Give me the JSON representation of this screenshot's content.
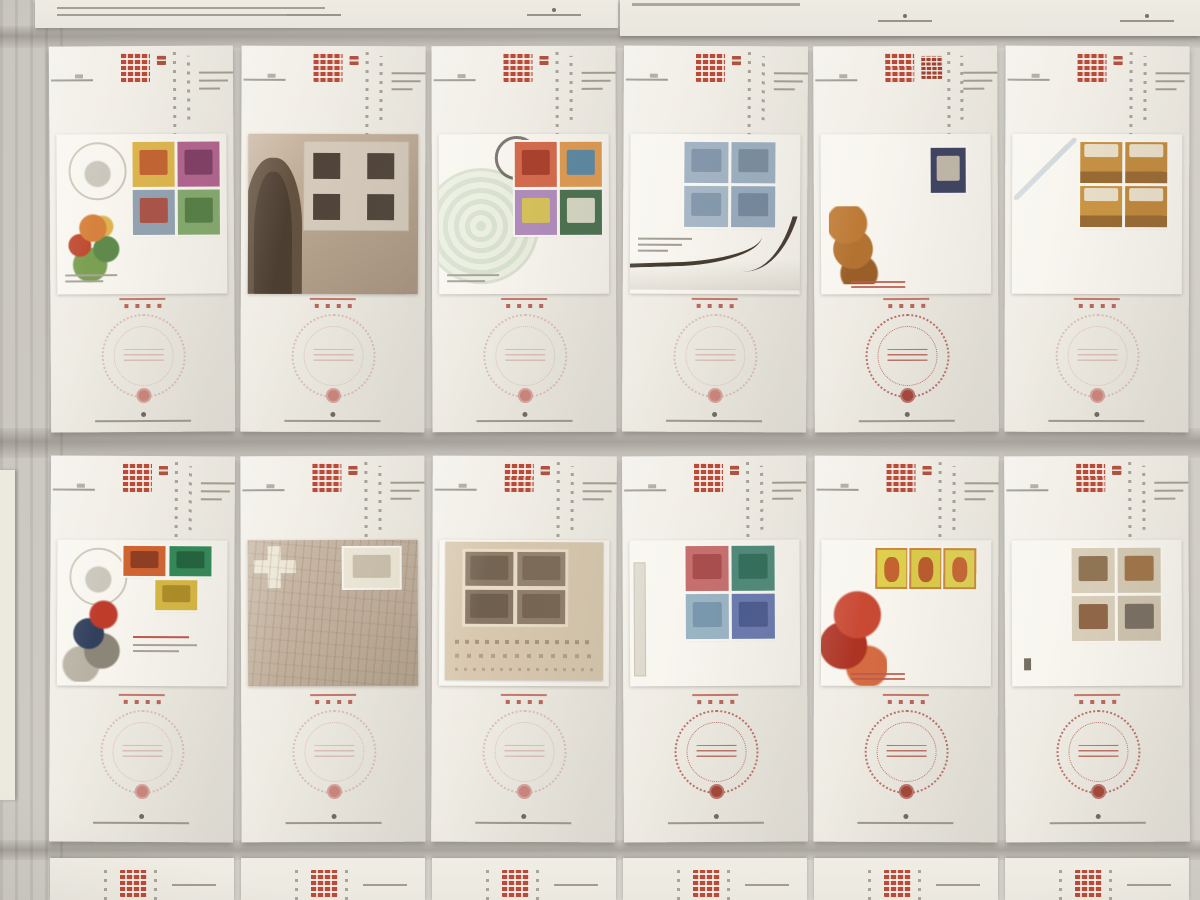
{
  "scene": {
    "type": "photograph",
    "subject": "Grid of Macau (澳門) first day cover philatelic information sheets laid on a gray cloth, two full rows of six sheets, rows above and below cut off at the image edges",
    "colors": {
      "background": "#d1cec7",
      "paper": "#f0ede4",
      "cover_white": "#f8f6ef",
      "title_red": "#bc4a37",
      "subtitle_red": "#b3503d",
      "postmark_light": "#d9b2ab",
      "postmark_strong": "#bd6a5e",
      "postmark_emblem": "#a33b2e",
      "facade_tan": "#bfa88f",
      "map_tan": "#c2b19c",
      "inner_sheet_tan": "#d8c8ae"
    },
    "grid": {
      "columns": 6,
      "full_rows": 2,
      "top_row_cut": true,
      "bottom_row_cut": true
    }
  },
  "sheet_title": "澳門",
  "bottom_row_visible_char": "澳",
  "rows": [
    {
      "name": "row-1",
      "sheets": [
        {
          "title": "澳門",
          "subtitle": "",
          "subtitle_chars": 5,
          "cover_kind": "plain",
          "decor": [
            "circle-sketch",
            "bouquet",
            "caption-lines"
          ],
          "stamps": {
            "layout": "g2x2R",
            "items": [
              {
                "c": "#dfb64a",
                "a": "#c25a2e"
              },
              {
                "c": "#b4628f",
                "a": "#7c3a62"
              },
              {
                "c": "#93a3b2",
                "a": "#b0493a"
              },
              {
                "c": "#83aa6b",
                "a": "#4d7a3e"
              }
            ]
          },
          "postmark": "light"
        },
        {
          "title": "澳門",
          "subtitle": "",
          "subtitle_chars": 3,
          "cover_kind": "facade",
          "decor": [
            "arch",
            "win-grid"
          ],
          "stamps": null,
          "postmark": "light"
        },
        {
          "title": "澳門",
          "subtitle": "花與公園",
          "subtitle_chars": 4,
          "cover_kind": "plain",
          "decor": [
            "medallion",
            "black-cancel",
            "caption-lines"
          ],
          "stamps": {
            "layout": "g2x2R",
            "items": [
              {
                "c": "#d8694a",
                "a": "#a83b28"
              },
              {
                "c": "#e09a4e",
                "a": "#4a86ad"
              },
              {
                "c": "#b18cbd",
                "a": "#ddc84a"
              },
              {
                "c": "#49704f",
                "a": "#e6e2d2"
              }
            ]
          },
          "postmark": "light"
        },
        {
          "title": "澳門",
          "subtitle": "",
          "subtitle_chars": 8,
          "cover_kind": "plain",
          "decor": [
            "text-block-l",
            "hull"
          ],
          "stamps": {
            "layout": "g2x2S",
            "items": [
              {
                "c": "#a3b4c6",
                "a": "#7e93aa"
              },
              {
                "c": "#9cb0c2",
                "a": "#75899f"
              },
              {
                "c": "#a8b8c8",
                "a": "#8096ac"
              },
              {
                "c": "#97abc0",
                "a": "#6f849b"
              }
            ]
          },
          "postmark": "light"
        },
        {
          "title": "澳門",
          "subtitle": "狗年",
          "subtitle_chars": 2,
          "subtitle_size": "large",
          "cover_kind": "plain",
          "decor": [
            "dog",
            "red-note"
          ],
          "stamps": {
            "layout": "single",
            "items": [
              {
                "c": "#3d4162",
                "a": "#cfc5b2"
              }
            ]
          },
          "postmark": "strong"
        },
        {
          "title": "澳門",
          "subtitle": "",
          "subtitle_chars": 6,
          "cover_kind": "plain",
          "decor": [
            "diagonal"
          ],
          "stamps": {
            "layout": "g2x2C",
            "cls": "atm",
            "items": [
              {
                "c": "#c8913f",
                "a": "#eadfc8"
              },
              {
                "c": "#c38a3a",
                "a": "#eadfc8"
              },
              {
                "c": "#cc953f",
                "a": "#eadfc8"
              },
              {
                "c": "#c08637",
                "a": "#eadfc8"
              }
            ]
          },
          "postmark": "light"
        }
      ]
    },
    {
      "name": "row-2",
      "sheets": [
        {
          "title": "澳門",
          "subtitle": "",
          "subtitle_chars": 8,
          "cover_kind": "plain",
          "decor": [
            "circle-sketch",
            "racer",
            "racer-note"
          ],
          "stamps": {
            "layout": "cars3",
            "items": [
              {
                "c": "#d4622f",
                "a": "#8a3a1f"
              },
              {
                "c": "#2f8a55",
                "a": "#1e5c38"
              },
              {
                "c": "#d8b83f",
                "a": "#a8891f"
              }
            ]
          },
          "postmark": "light"
        },
        {
          "title": "澳門",
          "subtitle": "",
          "subtitle_chars": 4,
          "cover_kind": "map",
          "decor": [
            "cross",
            "map-lines"
          ],
          "stamps": {
            "layout": "blockTR",
            "items": [
              {
                "c": "#efe9da",
                "a": "#c8bca6"
              }
            ]
          },
          "postmark": "light"
        },
        {
          "title": "澳門",
          "subtitle": "",
          "subtitle_chars": 6,
          "cover_kind": "plain",
          "decor": [
            "tan-sheet",
            "sketch-band"
          ],
          "stamps": {
            "layout": "photos",
            "cls": "photo",
            "items": [
              {
                "c": "#8d7c67",
                "a": "#6e5f4e"
              },
              {
                "c": "#948370",
                "a": "#756550"
              },
              {
                "c": "#887663",
                "a": "#695a48"
              },
              {
                "c": "#8f7e6a",
                "a": "#705f4c"
              }
            ]
          },
          "postmark": "light"
        },
        {
          "title": "澳門",
          "subtitle": "",
          "subtitle_chars": 7,
          "cover_kind": "plain",
          "decor": [
            "left-strip"
          ],
          "stamps": {
            "layout": "g2x2M",
            "items": [
              {
                "c": "#c96e6e",
                "a": "#a84848"
              },
              {
                "c": "#4e8a7a",
                "a": "#2f6a58"
              },
              {
                "c": "#9ab5c6",
                "a": "#7495ad"
              },
              {
                "c": "#6a7ab2",
                "a": "#48588f"
              }
            ]
          },
          "postmark": "strong"
        },
        {
          "title": "澳門",
          "subtitle": "傳說與神話",
          "subtitle_chars": 5,
          "cover_kind": "plain",
          "decor": [
            "deity",
            "red-note"
          ],
          "stamps": {
            "layout": "strip3",
            "cls": "yel",
            "items": [
              {
                "c": "#e0d049",
                "a": "#c2552a"
              },
              {
                "c": "#ddcc45",
                "a": "#b84f26"
              },
              {
                "c": "#e2d24e",
                "a": "#c65a2e"
              }
            ]
          },
          "postmark": "strong"
        },
        {
          "title": "澳門",
          "subtitle": "",
          "subtitle_chars": 9,
          "cover_kind": "plain",
          "decor": [
            "mini-mark"
          ],
          "stamps": {
            "layout": "g2x2P",
            "items": [
              {
                "c": "#d9cfba",
                "a": "#8a6a48"
              },
              {
                "c": "#d4c9b2",
                "a": "#9a6a3a"
              },
              {
                "c": "#d9cfba",
                "a": "#8a5a3a"
              },
              {
                "c": "#cfc4ad",
                "a": "#6e665a"
              }
            ]
          },
          "postmark": "strong"
        }
      ]
    }
  ],
  "top_row_fragments": {
    "left_sheet": {
      "has_text_block": true,
      "foot_marks": 2
    },
    "right_sheet": {
      "has_text_line": true,
      "foot_marks": 2
    }
  }
}
